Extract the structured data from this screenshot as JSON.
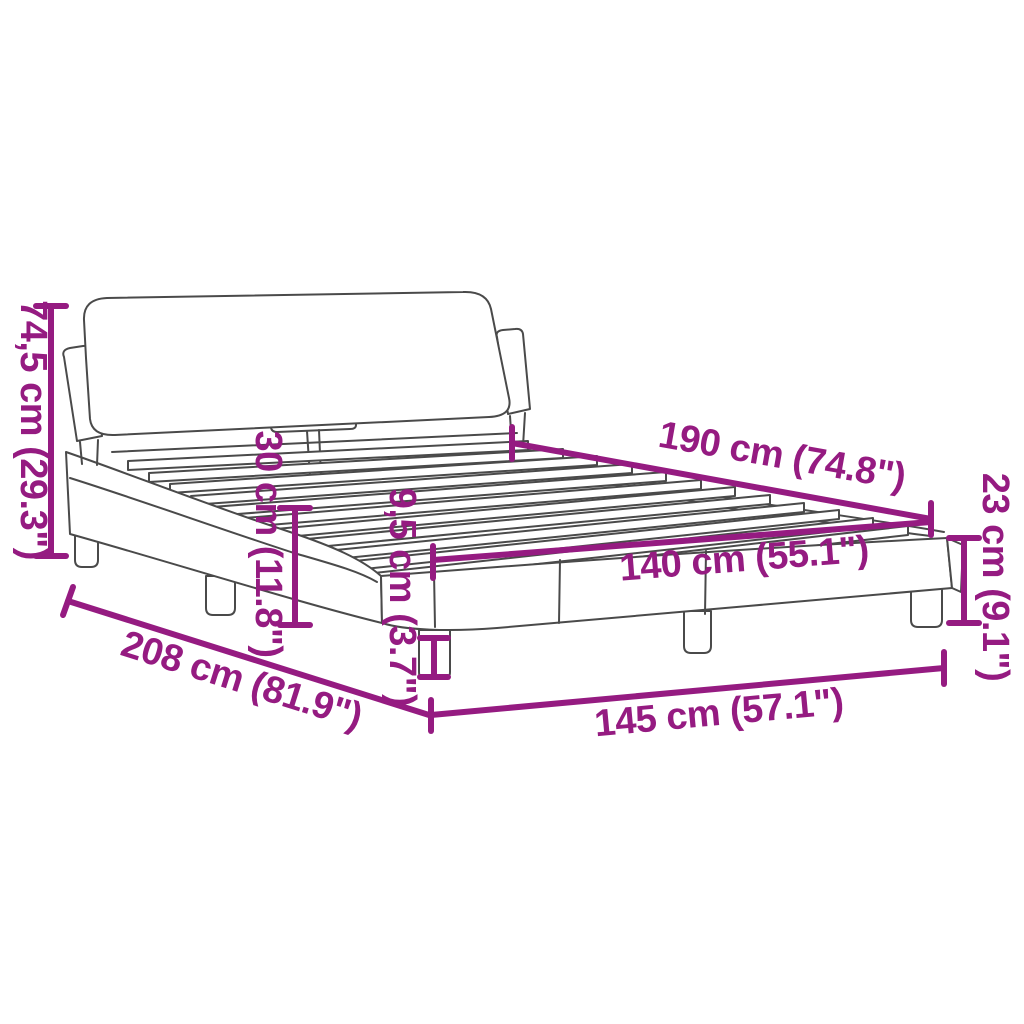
{
  "diagram": {
    "subject": "bed-frame-with-headboard-dimension-drawing",
    "accent_color": "#951B81",
    "line_color": "#4a4a4a",
    "background_color": "#ffffff",
    "dimensions": {
      "total_height": "74,5 cm (29.3\")",
      "headboard_clearance": "30 cm (11.8\")",
      "leg_height": "9,5 cm (3.7\")",
      "frame_corner_height": "23 cm (9.1\")",
      "slat_length": "190 cm (74.8\")",
      "slat_width": "140 cm (55.1\")",
      "total_length": "208 cm (81.9\")",
      "total_width": "145 cm (57.1\")"
    }
  }
}
